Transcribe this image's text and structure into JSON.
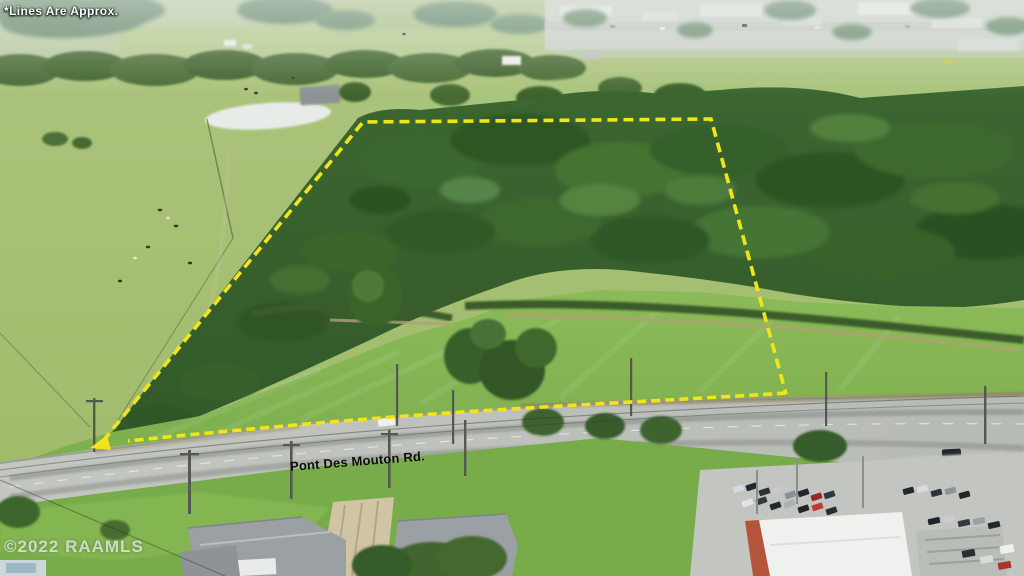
{
  "overlay": {
    "disclaimer": "*Lines Are Approx.",
    "road_name": "Pont Des Mouton Rd.",
    "watermark": "©2022 RAAMLS",
    "boundary_color": "#f2e41a"
  }
}
